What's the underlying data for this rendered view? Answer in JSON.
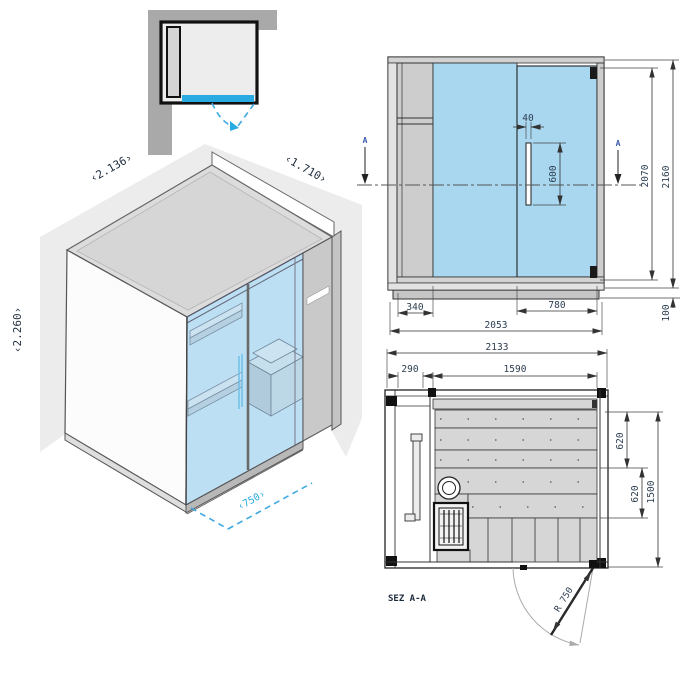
{
  "colors": {
    "accent_blue": "#29abe2",
    "glass_blue": "#a9d7f0",
    "panel_gray": "#cdcdcd",
    "backdrop_gray": "#ececec",
    "line_dark": "#222222",
    "dim_text": "#2c3e50",
    "section_marker_blue": "#3a5aaa"
  },
  "isometric": {
    "labels": {
      "width": "‹2.136›",
      "depth": "‹1.710›",
      "height": "‹2.260›",
      "door_width": "‹750›"
    }
  },
  "elevation": {
    "section_marker_left": "A",
    "section_marker_right": "A",
    "dims": {
      "handle_offset": "40",
      "handle_length": "600",
      "glass_height": "2070",
      "total_height": "2160",
      "side_panel_width": "340",
      "door_width": "780",
      "front_width": "2053",
      "base_height": "100"
    }
  },
  "plan": {
    "section_label": "SEZ A-A",
    "dims": {
      "total_width": "2133",
      "tech_compartment": "290",
      "interior_width": "1590",
      "bench_depth_upper": "620",
      "bench_depth_lower": "620",
      "interior_depth": "1500",
      "door_swing_radius": "R 750"
    }
  }
}
